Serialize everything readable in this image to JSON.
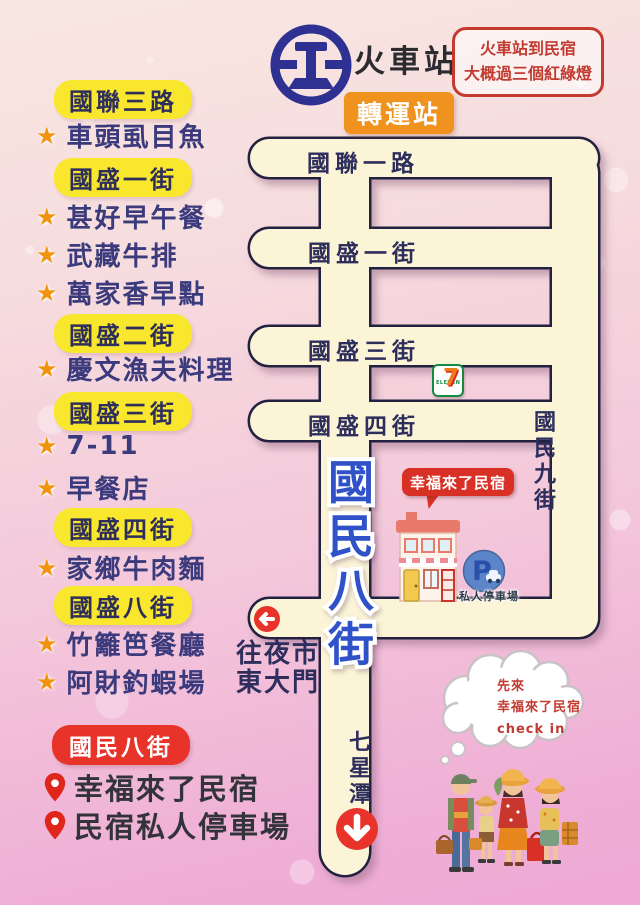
{
  "header": {
    "station": "火車站",
    "transfer_badge": "轉運站",
    "note_lines": [
      "火車站到民宿",
      "大概過三個紅綠燈"
    ]
  },
  "sidebar": {
    "items": [
      {
        "type": "street",
        "label": "國聯三路"
      },
      {
        "type": "place",
        "label": "車頭虱目魚"
      },
      {
        "type": "street",
        "label": "國盛一街"
      },
      {
        "type": "place",
        "label": "甚好早午餐"
      },
      {
        "type": "place",
        "label": "武藏牛排"
      },
      {
        "type": "place",
        "label": "萬家香早點"
      },
      {
        "type": "street",
        "label": "國盛二街"
      },
      {
        "type": "place",
        "label": "慶文漁夫料理"
      },
      {
        "type": "street",
        "label": "國盛三街"
      },
      {
        "type": "place",
        "label": "7-11"
      },
      {
        "type": "place",
        "label": "早餐店"
      },
      {
        "type": "street",
        "label": "國盛四街"
      },
      {
        "type": "place",
        "label": "家鄉牛肉麵"
      },
      {
        "type": "street",
        "label": "國盛八街"
      },
      {
        "type": "place",
        "label": "竹籬笆餐廳"
      },
      {
        "type": "place",
        "label": "阿財釣蝦場"
      }
    ],
    "destination": {
      "street_badge": "國民八街",
      "places": [
        "幸福來了民宿",
        "民宿私人停車場"
      ]
    }
  },
  "map": {
    "horizontal_roads": [
      "國聯一路",
      "國盛一街",
      "國盛三街",
      "國盛四街"
    ],
    "main_road_vertical": "國民八街",
    "right_road_vertical": "國民九街",
    "seven_eleven": {
      "digit": "7",
      "word": "ELEVEN"
    },
    "guesthouse_label": "幸福來了民宿",
    "parking_icon_letter": "P",
    "parking_label": "私人停車場",
    "night_market_lines": [
      "往夜市",
      "東大門"
    ],
    "qixingtan": "七星潭"
  },
  "thought_bubble": {
    "lines": [
      "先來",
      "幸福來了民宿",
      "check in"
    ]
  },
  "colors": {
    "road_fill": "#FBF4D7",
    "road_outline": "#23233F",
    "street_badge_yellow": "#F8E72C",
    "street_badge_red": "#E8332A",
    "transfer_orange": "#F0931E",
    "list_text_navy": "#3A3A7C",
    "star_orange": "#F2930D",
    "main_road_blue": "#2F52C8",
    "note_red": "#C23B30"
  }
}
